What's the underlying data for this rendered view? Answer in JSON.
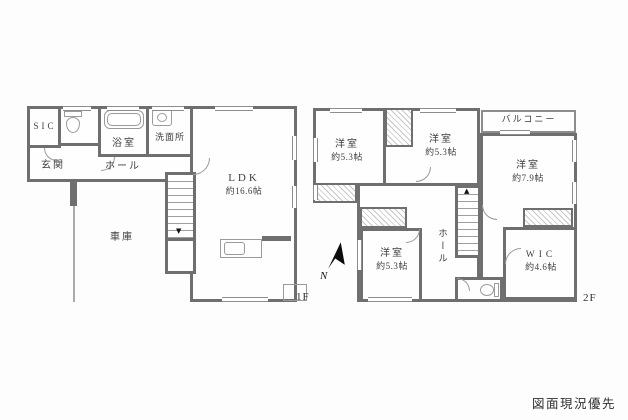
{
  "page": {
    "background": "#fdfdfd"
  },
  "colors": {
    "wall": "#6f6f6f",
    "thin_line": "#9a9a9a",
    "hatch": "#c7c7c7",
    "text": "#474747"
  },
  "floor1": {
    "floor_label": "1F",
    "rooms": {
      "sic": {
        "name": "SIC"
      },
      "entrance": {
        "name": "玄関"
      },
      "bath": {
        "name": "浴室"
      },
      "washroom": {
        "name": "洗面所"
      },
      "hall": {
        "name": "ホール"
      },
      "ldk": {
        "name": "LDK",
        "size": "約16.6帖"
      },
      "garage": {
        "name": "車庫"
      }
    }
  },
  "floor2": {
    "floor_label": "2F",
    "rooms": {
      "bedroom_nw": {
        "name": "洋室",
        "size": "約5.3帖"
      },
      "bedroom_n": {
        "name": "洋室",
        "size": "約5.3帖"
      },
      "bedroom_e": {
        "name": "洋室",
        "size": "約7.9帖"
      },
      "bedroom_s": {
        "name": "洋室",
        "size": "約5.3帖"
      },
      "balcony": {
        "name": "バルコニー"
      },
      "wic": {
        "name": "WIC",
        "size": "約4.6帖"
      },
      "hall": {
        "name": "ホール"
      }
    }
  },
  "compass": {
    "north_label": "N"
  },
  "footer": {
    "note": "図面現況優先"
  }
}
